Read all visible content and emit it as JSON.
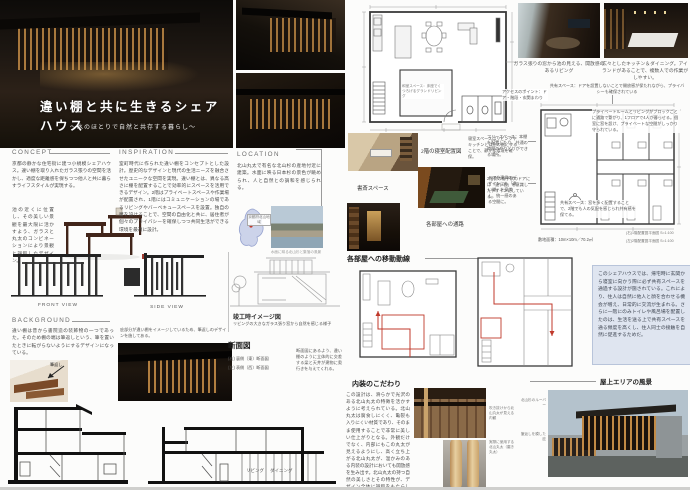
{
  "header": {
    "title": "違い棚と共に生きるシェアハウス",
    "subtitle": "〜水のほとりで自然と共存する暮らし〜"
  },
  "gallery": {
    "living_caption": "ガラス張りの窓から池の見える、開放感のあるリビング",
    "kitchen_caption": "広々としたキッチン＆ダイニング。アイランドがあることで、複数人での作業がしやすい。"
  },
  "concept": {
    "heading": "CONCEPT",
    "body1": "京都の静かな住宅街に建つ小規模シェアハウス。違い棚を取り入れたガラス張りの空間を活かし、適度な距離感を保ちつつ他人と共に暮らすライフスタイルが実現する。",
    "body2": "池の近くに位置し、その美しい景観を最大限に活かすよう、ガラスと丸太のコンビネーションにより景観と調和したデザイン。"
  },
  "inspiration": {
    "heading": "INSPIRATION",
    "body": "室町時代に作られた違い棚をコンセプトとした設計。歴史的なデザインと現代の生活ニーズを融合させたユニークな空間を実現。違い棚とは、異なる高さに棚を配置することで効率的にスペースを活用できるデザイン。2階はプライベートスペースや作業場が配置され、1階にはコミュニケーションの場であるリビングやバーベキュースペースを設置。独自の層を設けることで、空間の自由化と共に、居住者が個々のプライバシーを確保しつつ共同生活ができる環境を最適に設計。"
  },
  "location": {
    "heading": "LOCATION",
    "body": "北山丸太で有名な北山杉の産地付近に建築。水面に映る日本杉の景色が眺められ、人と自然との調和を感じられる。",
    "map_label": "京都府北山地域",
    "photo_caption": "水面に映る北山杉と集落の風景"
  },
  "views": {
    "front_label": "FRONT VIEW",
    "side_label": "SIDE VIEW"
  },
  "background": {
    "heading": "BACKGROUND",
    "body": "違い棚は昔から書院造の装飾物の一つであった。そのため棚の端は筆返しという、筆を置いたときに転がらないようにするデザインになっている。",
    "fudegaeshi_label": "筆返し",
    "note": "庇部分が違い棚をイメージしているため、筆返しのデザインを施してある。"
  },
  "sketch": {
    "label": "竣工時イメージ図",
    "caption": "リビングの大きなガラス張り窓から自然を感じる様子"
  },
  "sections": {
    "heading": "断面図",
    "item_right": "(右) 裏側（東）断面図",
    "item_left": "(左) 表側（西）断面図",
    "note": "断面図にあるよう、違い棚のように立体的に交差する梁と天井が建物に奥行きを与えてくれる。",
    "living": "リビング",
    "dining": "ダイニング"
  },
  "plan1f": {
    "room_note": "和室スペース：床座でくつろげるグランドリビング",
    "access_note": "アクセスのポイント：ドア・階段・玄関まわり"
  },
  "plan2f": {
    "top_note": "共有スペース：ドアを設置しないことで開放感が保たれながら、プライバシーも確保されている",
    "right_note": "プライベートルームとリビングがブロックごとに通路で繋がり、1フロアで4人が暮らせる。個室に窓を設け、プライベートな空間がしっかり守られている。",
    "left_note1": "フリースペース：本棚を配置したり、共通の時間のやりとりができる場所。",
    "left_note2": "2階側の格子状のドアには「違い棚」を意識したデザインにしている。",
    "bottom_note": "共有スペース：窓を多く配置することで、2階でも人の気配を感じられ共有感を保てる。",
    "site_area": "敷地面積：10m×10m／70.2㎡",
    "caption_right": "(右)1階配置図平面図 S=1:100",
    "caption_left": "(左)2階配置図平面図 S=1:100"
  },
  "rooms": {
    "plan_label": "2階の寝室配置図",
    "note1": "寝室スペースはリビングやキッチンとは別の階にすることで、静かな環境を確保。",
    "study_label": "書斎スペース",
    "note2": "ドアや建具のデザインにも「違い棚」を意識し、統一感のある空間に。",
    "corridor_label": "各部屋への通路"
  },
  "circulation": {
    "heading": "各部屋への移動動線",
    "box": "このシェアハウスでは、帰宅時に玄関から寝室に向かう際に必ず共有スペースを通過する設計が施されている。これにより、住人は自然に他人と顔を合わせる機会が増え、日常的に交流が生まれる。さらに一階にのみトイレや風呂場を配置したのは、生活を送る上で共有スペースを通る頻度を高くし、住人同士の接触を自然に促進するためだ。"
  },
  "interior": {
    "heading": "内装のこだわり",
    "body": "この設計は、滑らかで光沢のある北山丸太の特徴を活かすように考えられている。北山丸太は腐食しにくく、亀裂も入りにくい材質であり、そのまま使用することで非常に美しい仕上がりとなる。外観だけでなく、内部にもこの丸太が見えるようにし、高く立ち上がる北山丸太が、温かみのある内装の設計においても開放感を生み出す。北山丸太の持つ自然の美しさとその特性が、デザイン全体に調和をもたらしている。",
    "caption1": "吹き抜けから北山丸太が見える内観",
    "caption2": "実際に使用する北山丸太（磨き丸太）"
  },
  "rooftop": {
    "label": "屋上エリアの風景",
    "note1": "北山杉のルーバー",
    "note2": "筆返しを模した庇"
  }
}
